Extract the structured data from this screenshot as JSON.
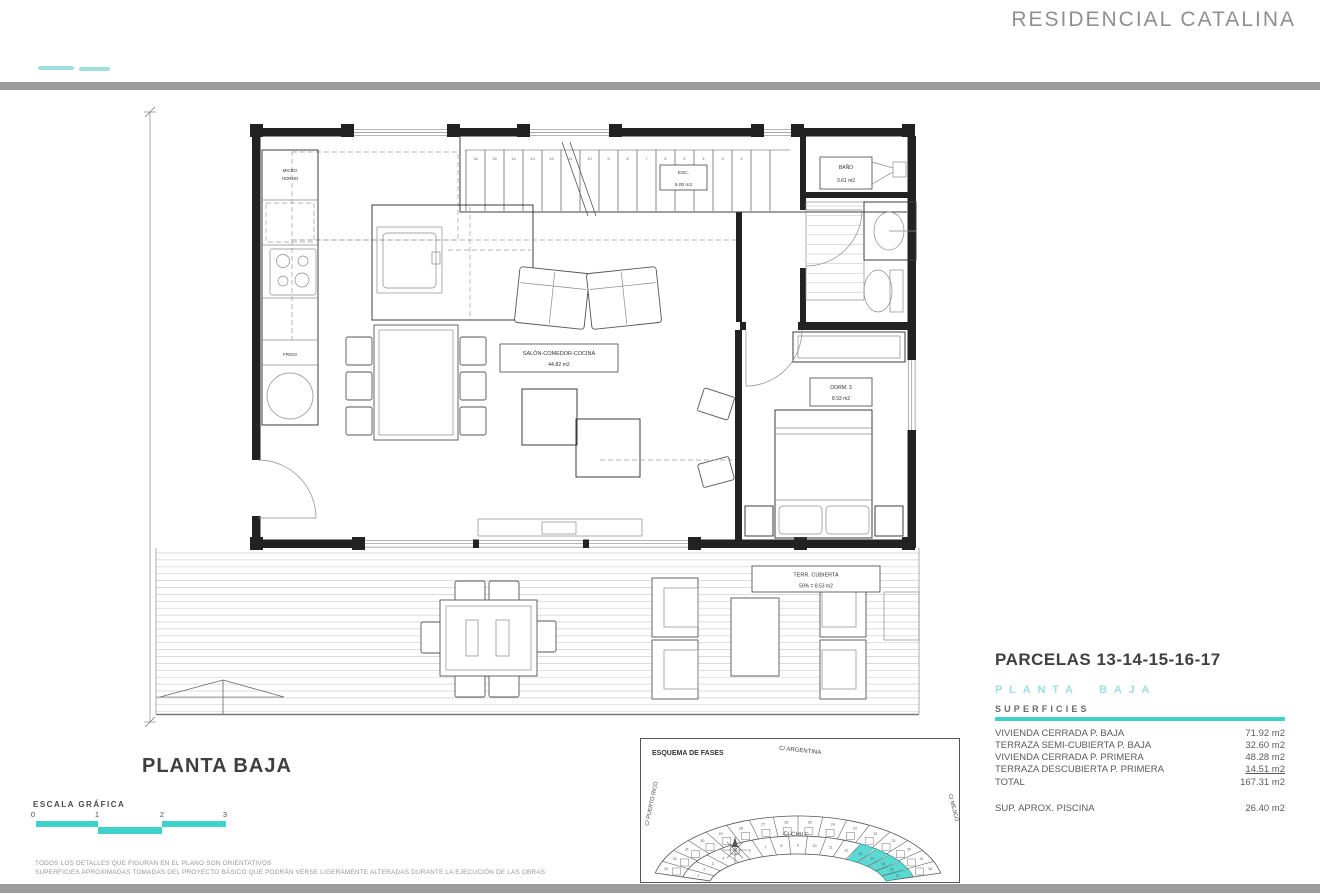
{
  "header": {
    "title": "RESIDENCIAL CATALINA",
    "accent_color": "#3fd2cb",
    "accent_light": "#9fe0db",
    "bar_color": "#9c9c9c"
  },
  "plan": {
    "title": "PLANTA BAJA",
    "labels": {
      "salon_name": "SALÓN-COMEDOR-COCINA",
      "salon_area": "44.82 m2",
      "esc_name": "ESC.",
      "esc_area": "5.00 m2",
      "bano_name": "BAÑO",
      "bano_area": "3.61 m2",
      "dorm_name": "DORM. 3",
      "dorm_area": "8.93 m2",
      "terraza_name": "TERR. CUBIERTA",
      "terraza_area": "50% = 8.53 m2",
      "micro_line1": "MICRO",
      "micro_line2": "HORNO",
      "frigo": "FRIGO"
    },
    "stair_numbers": [
      "16",
      "15",
      "14",
      "13",
      "12",
      "11",
      "10",
      "9",
      "8",
      "7",
      "6",
      "5",
      "4",
      "3",
      "2"
    ],
    "stair_first": "1"
  },
  "summary": {
    "parcelas_title": "PARCELAS 13-14-15-16-17",
    "planta_title": "PLANTA BAJA",
    "superficies_title": "SUPERFICIES",
    "rows": [
      {
        "label": "VIVIENDA CERRADA P. BAJA",
        "value": "71.92 m2"
      },
      {
        "label": "TERRAZA SEMI-CUBIERTA P. BAJA",
        "value": "32.60 m2"
      },
      {
        "label": "VIVIENDA CERRADA P. PRIMERA",
        "value": "48.28 m2"
      },
      {
        "label": "TERRAZA DESCUBIERTA P. PRIMERA",
        "value": "14.51 m2"
      },
      {
        "label": "TOTAL",
        "value": "167.31 m2"
      }
    ],
    "piscina_label": "SUP. APROX. PISCINA",
    "piscina_value": "26.40 m2"
  },
  "site_plan": {
    "title": "ESQUEMA DE FASES",
    "streets": {
      "top": "C/ ARGENTINA",
      "left": "C/ PUERTO RICO",
      "bottom": "C/ CHILE",
      "right": "C/ MEJICO"
    },
    "outer_row": [
      "33",
      "32",
      "31",
      "30",
      "29",
      "28",
      "27",
      "26",
      "25",
      "24",
      "23",
      "22",
      "21",
      "20",
      "19",
      "18"
    ],
    "inner_row": [
      "1",
      "2",
      "3",
      "4",
      "5",
      "6",
      "7",
      "8",
      "9",
      "10",
      "11",
      "12",
      "13",
      "14",
      "15",
      "16",
      "17"
    ],
    "highlighted": [
      "13",
      "14",
      "15",
      "16",
      "17"
    ],
    "highlight_color": "#3fd2cb"
  },
  "scale_bar": {
    "label": "ESCALA GRÁFICA",
    "ticks": [
      "0",
      "1",
      "2",
      "3"
    ]
  },
  "footer": {
    "line1": "TODOS LOS DETALLES QUE FIGURAN EN EL PLANO SON ORIENTATIVOS",
    "line2": "SUPERFICIES APROXIMADAS TOMADAS DEL PROYECTO BÁSICO QUE PODRÁN VERSE LIGERAMENTE ALTERADAS DURANTE LA EJECUCIÓN DE LAS OBRAS"
  }
}
